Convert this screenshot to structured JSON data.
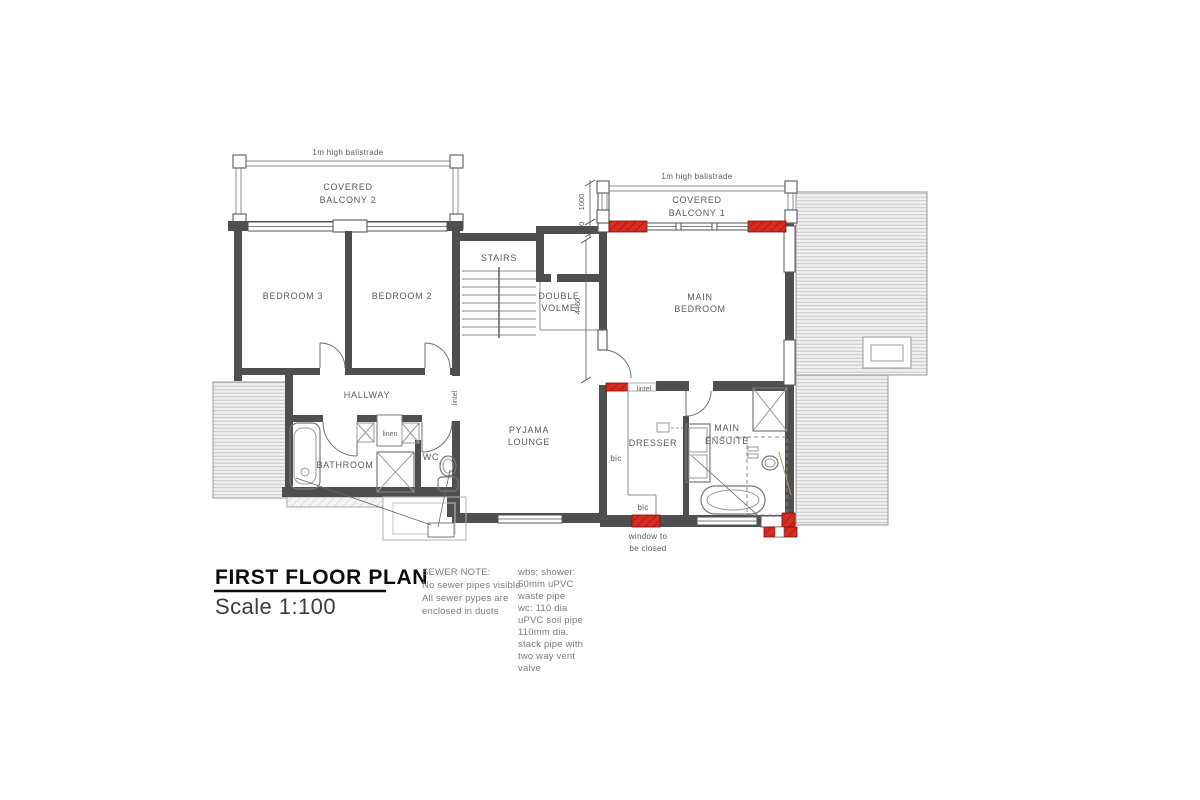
{
  "title_block": {
    "title": "FIRST FLOOR PLAN",
    "scale": "Scale 1:100"
  },
  "sewer_note": {
    "heading": "SEWER NOTE:",
    "line1": "No sewer pipes visible",
    "line2": "All sewer pypes are",
    "line3": "enclosed in ducts"
  },
  "plumbing_note": {
    "line1": "wbs; shower:",
    "line2": "50mm uPVC",
    "line3": "waste pipe",
    "line4": "wc: 110 dia",
    "line5": "uPVC soil pipe",
    "line6": "110mm dia.",
    "line7": "stack pipe with",
    "line8": "two way vent",
    "line9": "valve"
  },
  "rooms": {
    "covered_balcony_2_l1": "COVERED",
    "covered_balcony_2_l2": "BALCONY 2",
    "covered_balcony_1_l1": "COVERED",
    "covered_balcony_1_l2": "BALCONY 1",
    "bedroom_3": "BEDROOM 3",
    "bedroom_2": "BEDROOM 2",
    "stairs": "STAIRS",
    "double_volume_l1": "DOUBLE",
    "double_volume_l2": "VOLME",
    "main_bedroom_l1": "MAIN",
    "main_bedroom_l2": "BEDROOM",
    "hallway": "HALLWAY",
    "bathroom": "BATHROOM",
    "wc": "WC",
    "pyjama_lounge_l1": "PYJAMA",
    "pyjama_lounge_l2": "LOUNGE",
    "dresser": "DRESSER",
    "main_ensuite_l1": "MAIN",
    "main_ensuite_l2": "ENSUITE"
  },
  "annotations": {
    "balustrade_2": "1m high balistrade",
    "balustrade_1": "1m high balistrade",
    "linen": "linen",
    "lintel_hallway": "lintel",
    "lintel_bedroom": "lintel",
    "bic_side": "bic",
    "bic_bottom": "bic",
    "window_closed_l1": "window to",
    "window_closed_l2": "be closed"
  },
  "dimensions": {
    "balcony_height": "1000",
    "wall_thickness": "230",
    "double_volume_height": "4460"
  },
  "colors": {
    "highlight_red": "#d92b1f",
    "wall_dark": "#4f4f4f",
    "label_gray": "#5a5a5a",
    "roof_fill": "#f0f0f0",
    "hatch_line": "#c9c9c9"
  }
}
